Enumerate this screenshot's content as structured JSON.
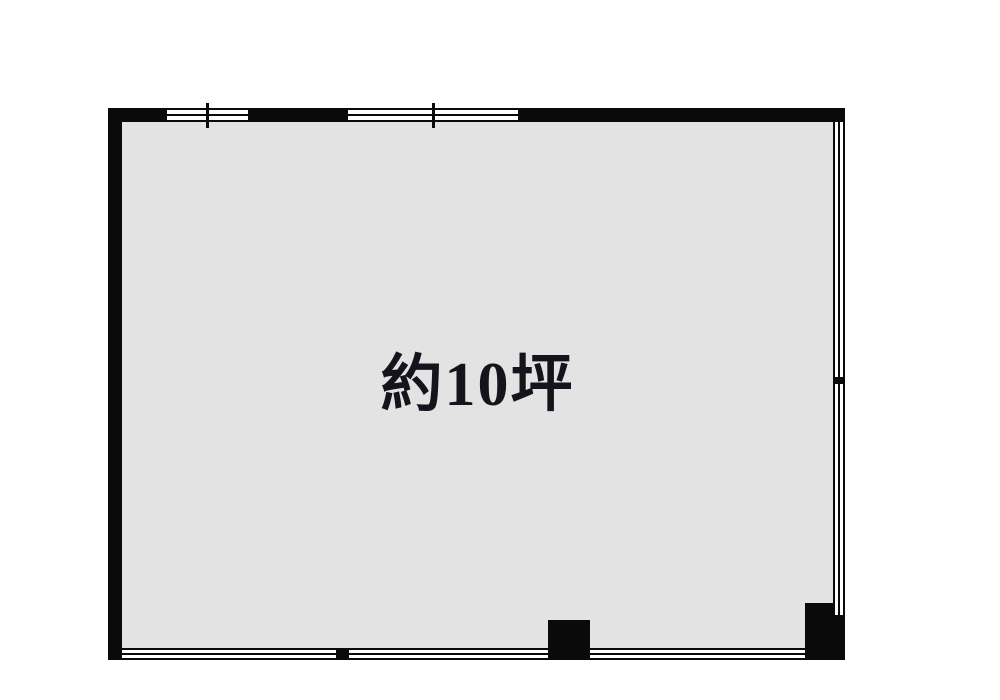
{
  "floorplan": {
    "area_label": "約10坪"
  },
  "colors": {
    "wall": "#0a0a0a",
    "floor": "#e3e3e3",
    "label_text": "#14141c",
    "background": "#ffffff"
  }
}
